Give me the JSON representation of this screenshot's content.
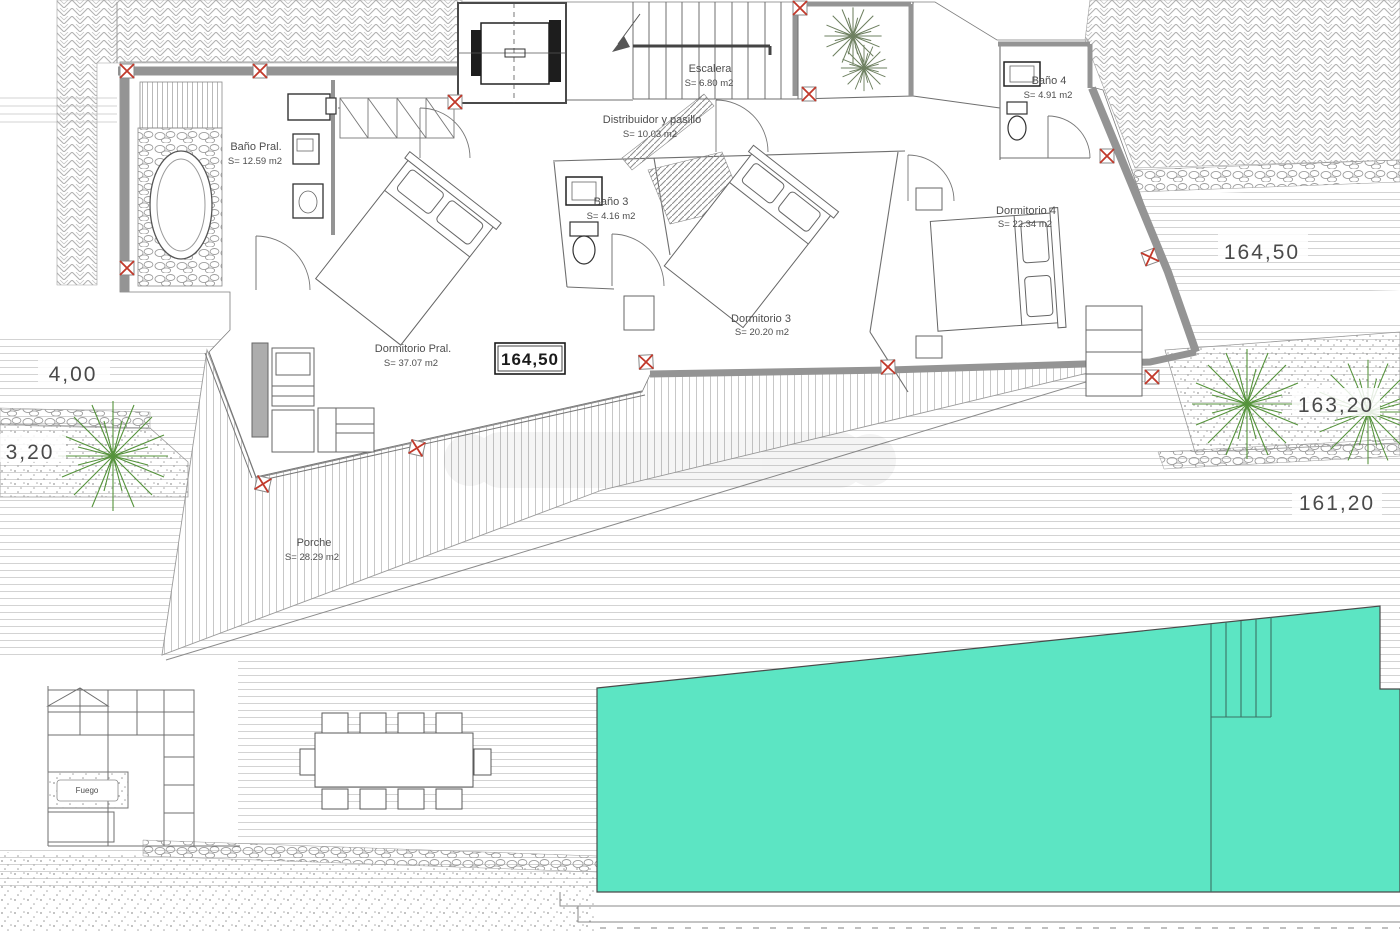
{
  "rooms": {
    "bano_pral": {
      "name": "Baño Pral.",
      "area": "S= 12.59 m2"
    },
    "escalera": {
      "name": "Escalera",
      "area": "S= 6.80 m2"
    },
    "distribuidor": {
      "name": "Distribuidor y pasillo",
      "area": "S= 10.03 m2"
    },
    "bano4": {
      "name": "Baño 4",
      "area": "S= 4.91 m2"
    },
    "bano3": {
      "name": "Baño 3",
      "area": "S= 4.16 m2"
    },
    "dorm4": {
      "name": "Dormitorio 4",
      "area": "S= 22.34 m2"
    },
    "dorm3": {
      "name": "Dormitorio 3",
      "area": "S= 20.20 m2"
    },
    "dorm_pral": {
      "name": "Dormitorio Pral.",
      "area": "S= 37.07 m2"
    },
    "porche": {
      "name": "Porche",
      "area": "S= 28.29 m2"
    }
  },
  "levels": {
    "floor_boxed": "164,50",
    "terrace_right": "164,50",
    "garden_mid_right": "163,20",
    "garden_low_right": "161,20",
    "left_upper": "4,00",
    "left_lower": "3,20"
  },
  "features": {
    "fire_pit": "Fuego"
  },
  "colors": {
    "pool": "#5CE5C3",
    "wall": "#949494",
    "marker_red": "#C2392B",
    "plant_green": "#55933B",
    "text": "#4E4E4E"
  }
}
